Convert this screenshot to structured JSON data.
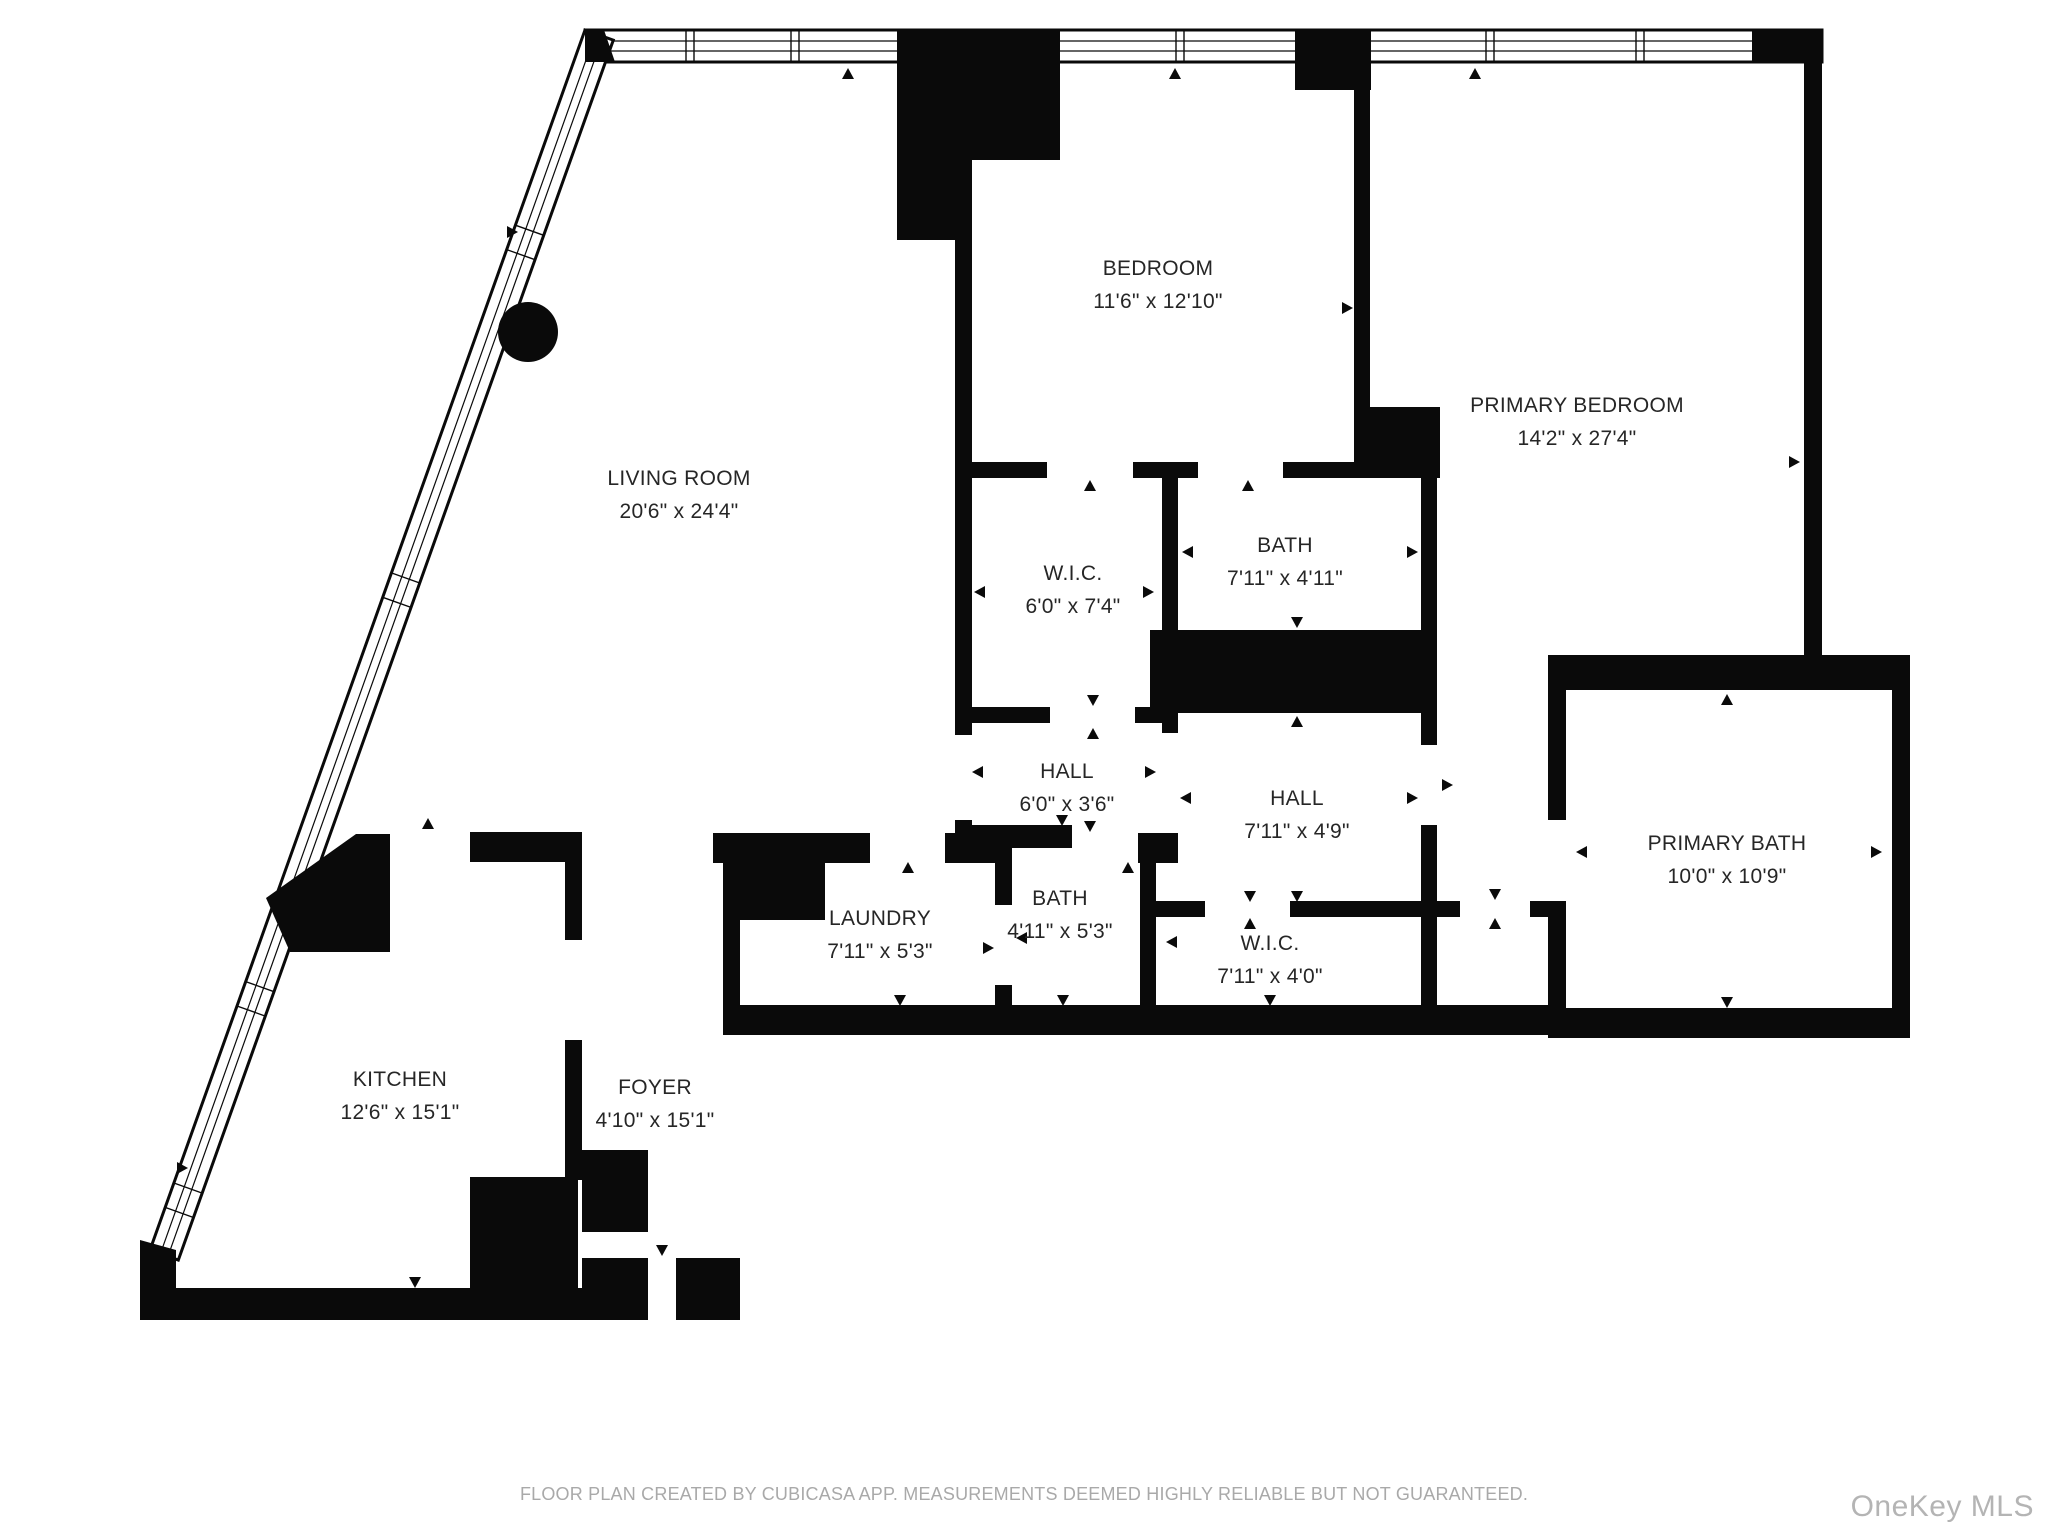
{
  "colors": {
    "wall": "#0a0a0a",
    "background": "#ffffff",
    "label_text": "#262626",
    "footer_text": "#a9a9a9",
    "watermark_text": "#b4b4b4"
  },
  "rooms": [
    {
      "name": "LIVING ROOM",
      "dims": "20'6\" x 24'4\""
    },
    {
      "name": "BEDROOM",
      "dims": "11'6\" x 12'10\""
    },
    {
      "name": "PRIMARY BEDROOM",
      "dims": "14'2\" x 27'4\""
    },
    {
      "name": "W.I.C.",
      "dims": "6'0\" x 7'4\""
    },
    {
      "name": "BATH",
      "dims": "7'11\" x 4'11\""
    },
    {
      "name": "HALL",
      "dims": "6'0\" x 3'6\""
    },
    {
      "name": "HALL",
      "dims": "7'11\" x 4'9\""
    },
    {
      "name": "PRIMARY BATH",
      "dims": "10'0\" x 10'9\""
    },
    {
      "name": "LAUNDRY",
      "dims": "7'11\" x 5'3\""
    },
    {
      "name": "BATH",
      "dims": "4'11\" x 5'3\""
    },
    {
      "name": "W.I.C.",
      "dims": "7'11\" x 4'0\""
    },
    {
      "name": "KITCHEN",
      "dims": "12'6\" x 15'1\""
    },
    {
      "name": "FOYER",
      "dims": "4'10\" x 15'1\""
    }
  ],
  "markers": {
    "door_marker": "small black triangle",
    "window_marker": "double-line window band",
    "column_marker": "solid black circle"
  },
  "footer": {
    "disclaimer": "FLOOR PLAN CREATED BY CUBICASA APP. MEASUREMENTS DEEMED HIGHLY RELIABLE BUT NOT GUARANTEED."
  },
  "watermark": {
    "label": "OneKey MLS"
  }
}
